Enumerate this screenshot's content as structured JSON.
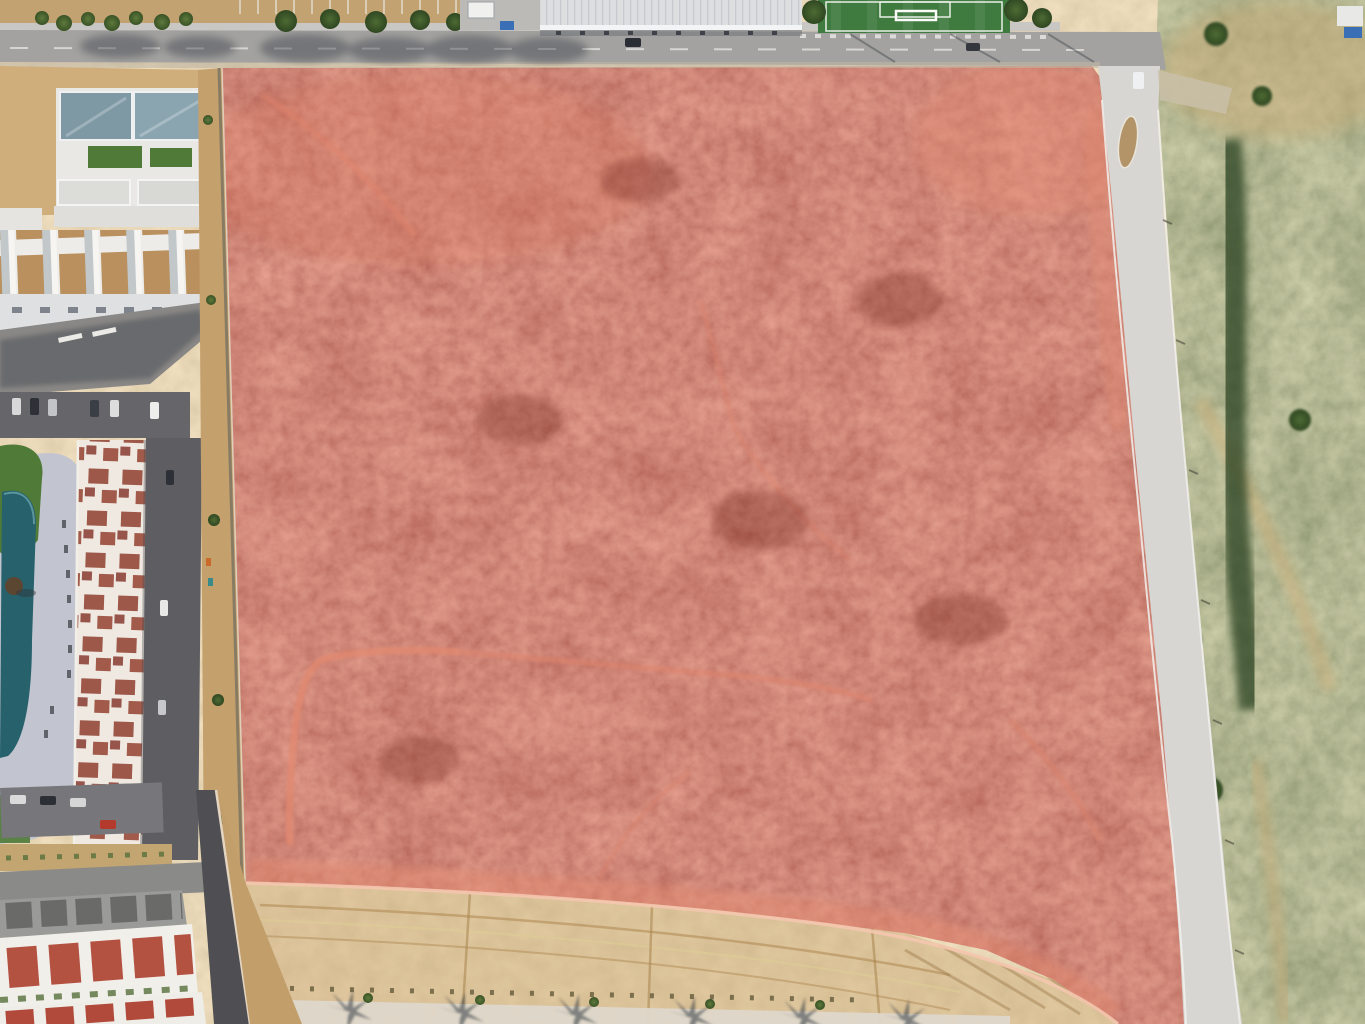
{
  "scene": {
    "alt_text": "Aerial drone photograph of a vacant scrubland development parcel highlighted with a translucent red overlay, bounded by a road to the north and east, a residential complex with a lagoon pool to the west, a warehouse and soccer field to the north, graded earthworks to the south and a brushy desert hillside to the east."
  },
  "colors": {
    "parcel_overlay": "#c03a2b",
    "parcel_trail": "#e8997e",
    "parcel_boundary_line": "#f4c7ae",
    "road_asphalt": "#a3a2a0",
    "road_concrete": "#d7d6d2",
    "sidewalk": "#c8c7c3",
    "dirt_ground": "#cfae78",
    "graded_dirt": "#cba875",
    "hillside_soil": "#b3996b",
    "soccer_turf": "#3f7a3f",
    "pool_water": "#27616c",
    "pool_deck": "#c2c5cf",
    "lawn_green": "#4f7a37",
    "terracotta_roof": "#9e5849",
    "rowhouse_roof": "#b14a3a",
    "warehouse_roof": "#dcdee0",
    "asphalt_dark": "#5e5e62",
    "wall_line": "#e3d5c2",
    "concrete_pad": "#ded7ca",
    "tree_green": "#3d5a2b"
  },
  "parcel": {
    "points": "222,68 1092,66 1106,86 1118,130 1126,200 1136,320 1148,450 1160,580 1170,700 1178,820 1186,950 1188,1024 1118,1024 1054,980 986,950 904,933 816,922 714,910 606,901 496,894 386,888 296,884 246,883 240,750 236,610 232,460 228,300 224,150",
    "boundary_line": "M 246,883 C 420,888 640,900 830,925 C 960,943 1060,978 1118,1024"
  }
}
